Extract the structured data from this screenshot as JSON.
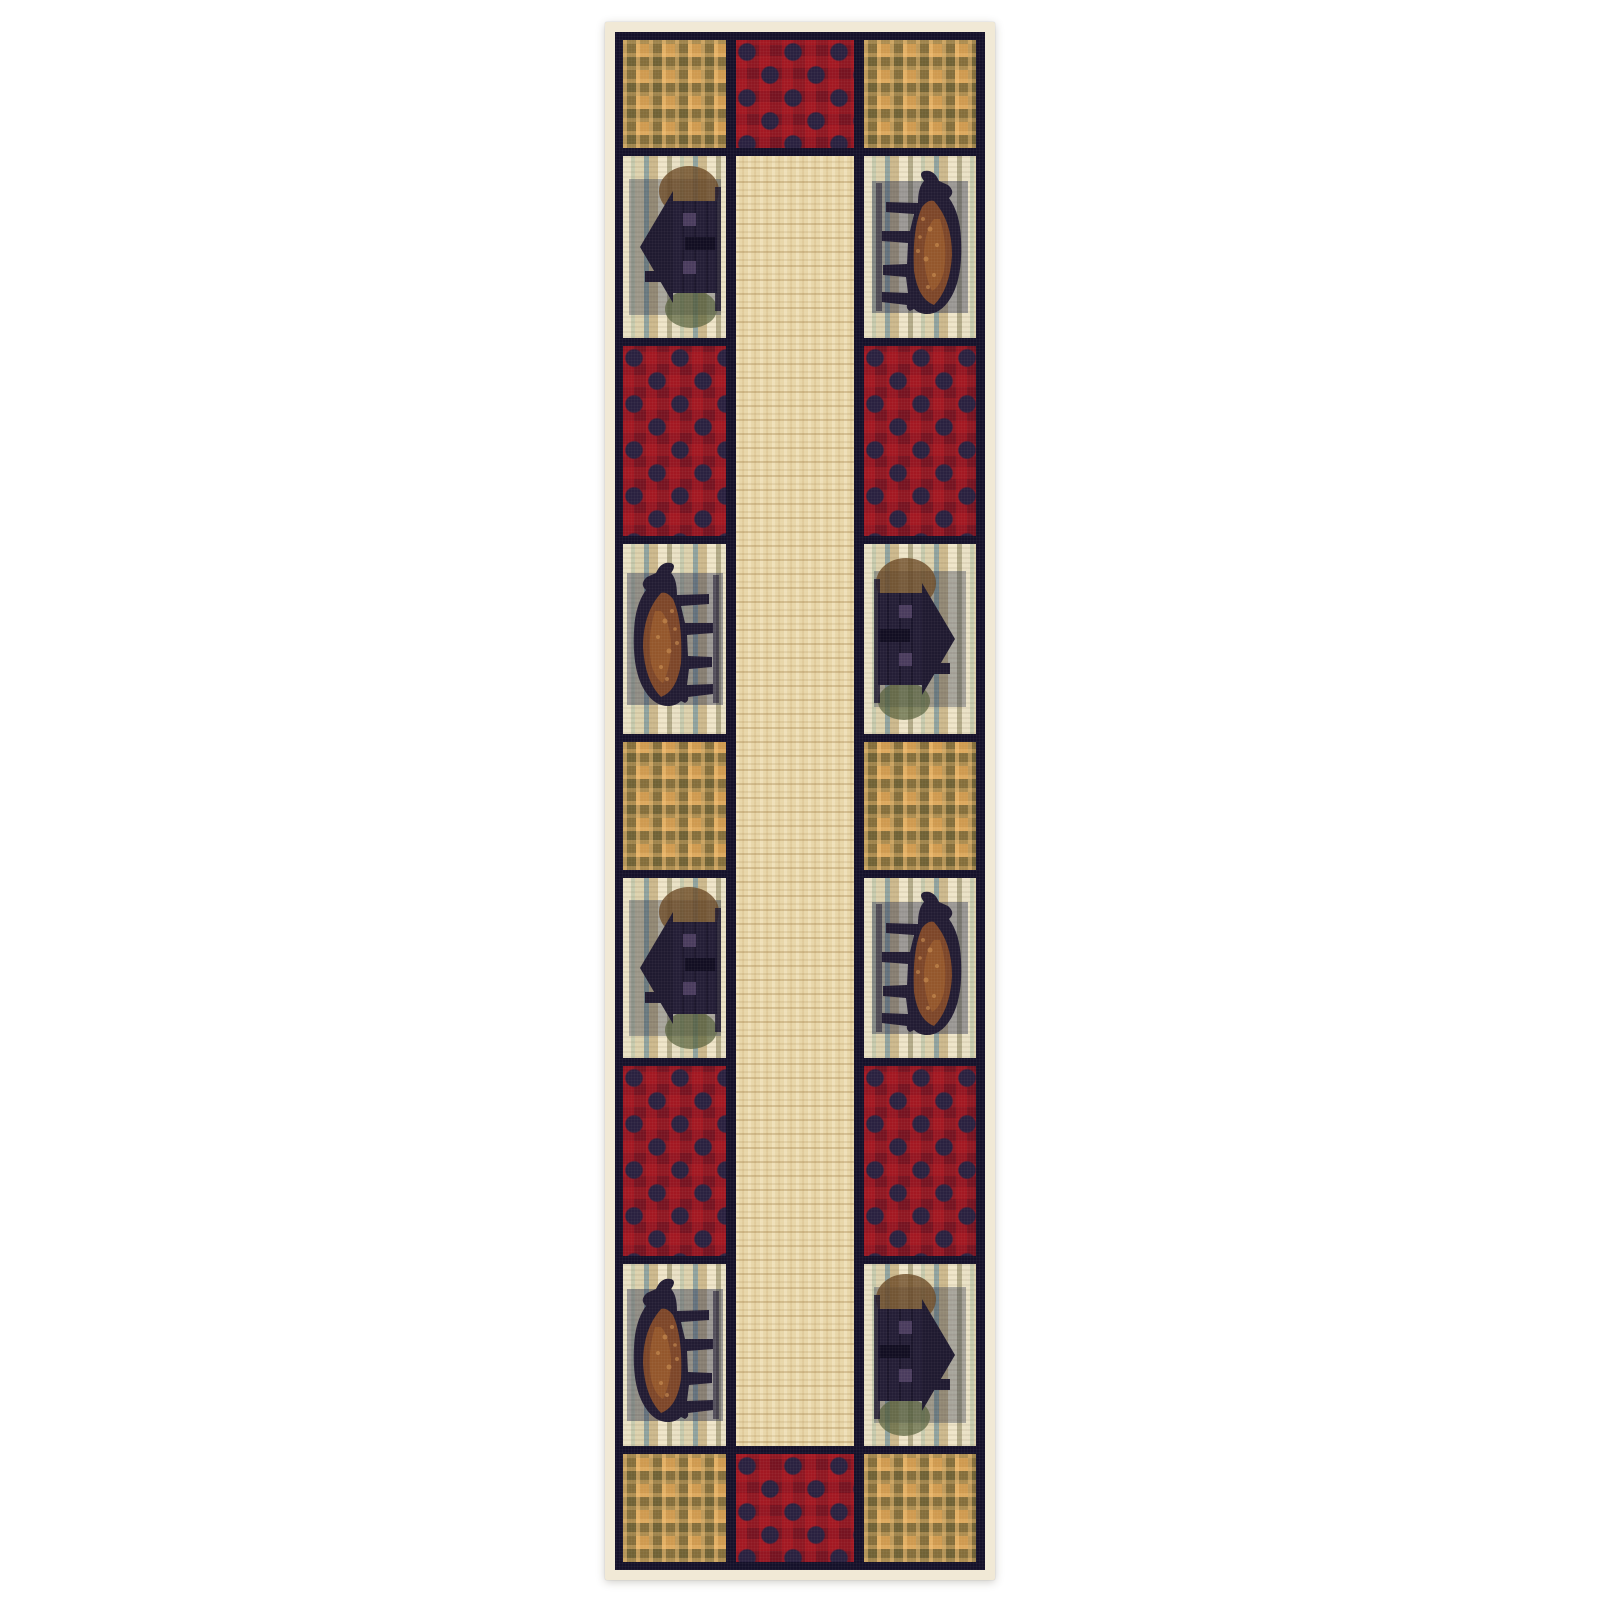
{
  "image": {
    "kind": "product-photo",
    "subject": "lodge-style runner rug with bear and cabin patchwork",
    "background_color": "#ffffff"
  },
  "rug": {
    "orientation": "vertical-runner",
    "colors": {
      "ivory_binding": "#f1e9d6",
      "navy_frame": "#15112a",
      "plaid_gold": "#cf9a50",
      "plaid_olive": "#685d33",
      "check_red": "#8f1722",
      "check_navy": "#2a2140",
      "field_beige": "#e8d6a9",
      "scene_cream": "#eae1c6",
      "scene_bluegray": "#8fa3a0",
      "bear_brown": "#8a4c28",
      "silhouette_navy": "#221c33"
    },
    "top_border": [
      "plaid",
      "buffalo-check",
      "plaid"
    ],
    "left_column": [
      "cabin-scene",
      "buffalo-check",
      "bear-scene",
      "plaid",
      "cabin-scene",
      "buffalo-check",
      "bear-scene"
    ],
    "center": "beige-stripe",
    "right_column": [
      "bear-scene",
      "buffalo-check",
      "cabin-scene",
      "plaid",
      "bear-scene",
      "buffalo-check",
      "cabin-scene"
    ],
    "bottom_border": [
      "plaid",
      "buffalo-check",
      "plaid"
    ],
    "motif_names": [
      "black-bear-motif",
      "log-cabin-motif",
      "gingham-plaid-patch",
      "buffalo-check-patch",
      "birch-forest-background"
    ]
  }
}
